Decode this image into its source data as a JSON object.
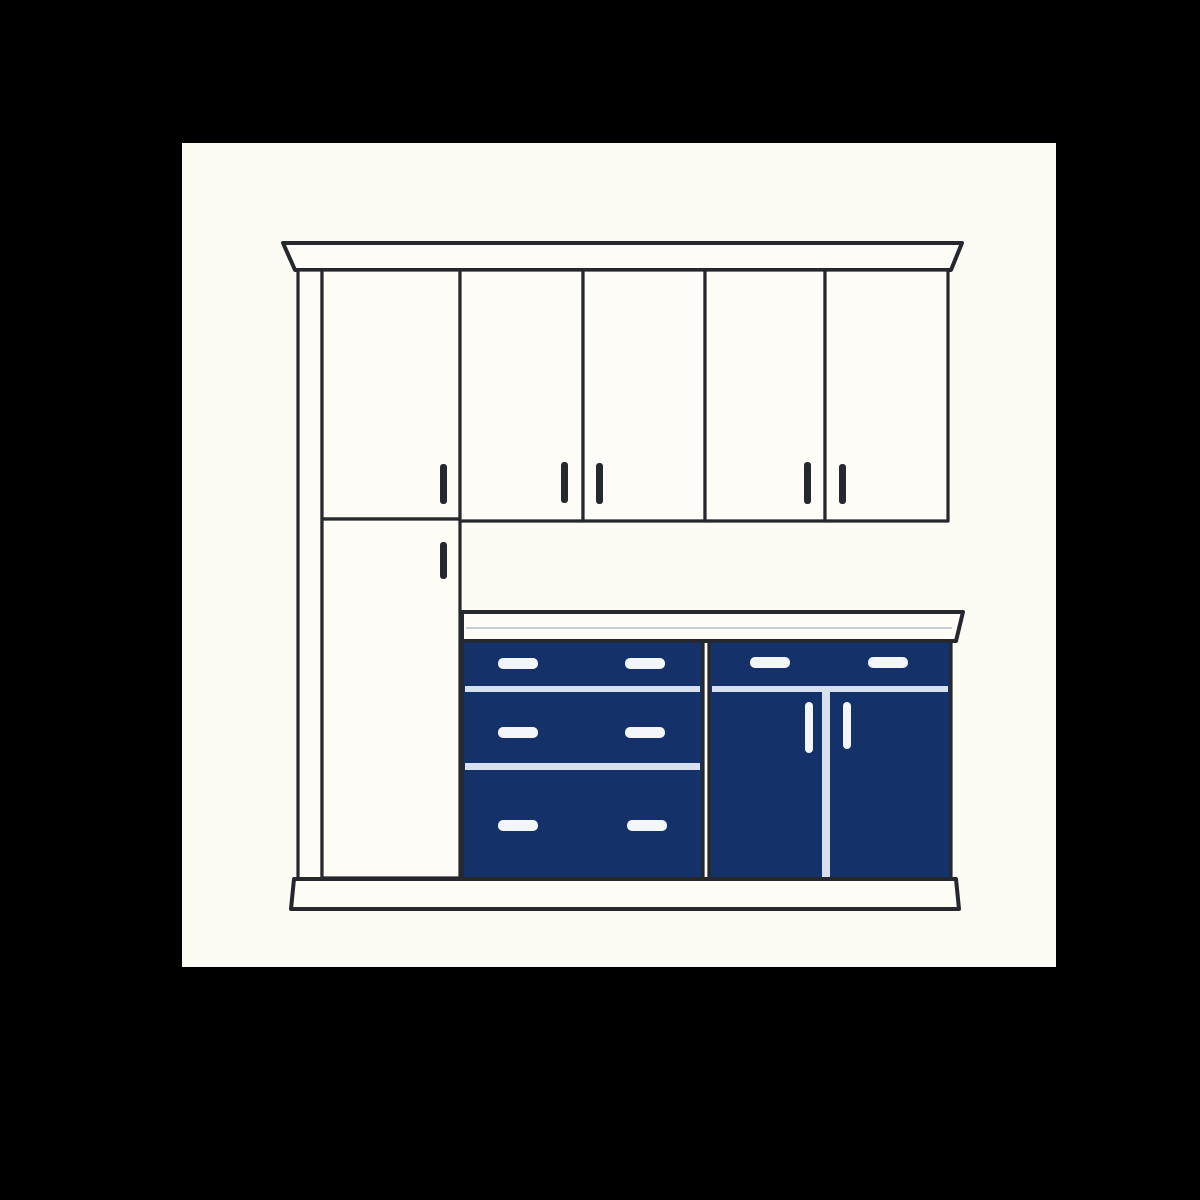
{
  "meta": {
    "title": "Kitchen cabinet elevation illustration",
    "description": "Line drawing of kitchen cabinetry with white upper cabinets, tall pantry cabinet, white countertop and navy blue base cabinets on a cream canvas over a black background"
  },
  "colors": {
    "background": "#000000",
    "canvas": "#FDFCF4",
    "outline": "#27272E",
    "cabinet_face": "#FDFCF7",
    "navy": "#143269",
    "light_divider": "#D7E0EE",
    "handle_light": "#F3F6FB",
    "counter_accent": "#C9CDD2"
  },
  "scene": {
    "crown_molding": "crown molding cornice",
    "tall_cabinet": {
      "label": "tall pantry cabinet",
      "doors": 2,
      "handle_style": "dark vertical dash"
    },
    "wall_cabinets": {
      "label": "upper wall cabinets",
      "doors": 4,
      "handle_style": "dark vertical dash"
    },
    "countertop": {
      "label": "white countertop slab"
    },
    "drawer_bank": {
      "label": "navy three-drawer base bank",
      "drawers": 3,
      "handles_per_drawer": 2,
      "handle_style": "light horizontal bar"
    },
    "door_base_unit": {
      "label": "navy base unit with top drawer and two doors",
      "drawers": 1,
      "doors": 2,
      "handle_style": "light bars"
    },
    "toe_kick": {
      "label": "white toe kick plinth"
    }
  }
}
